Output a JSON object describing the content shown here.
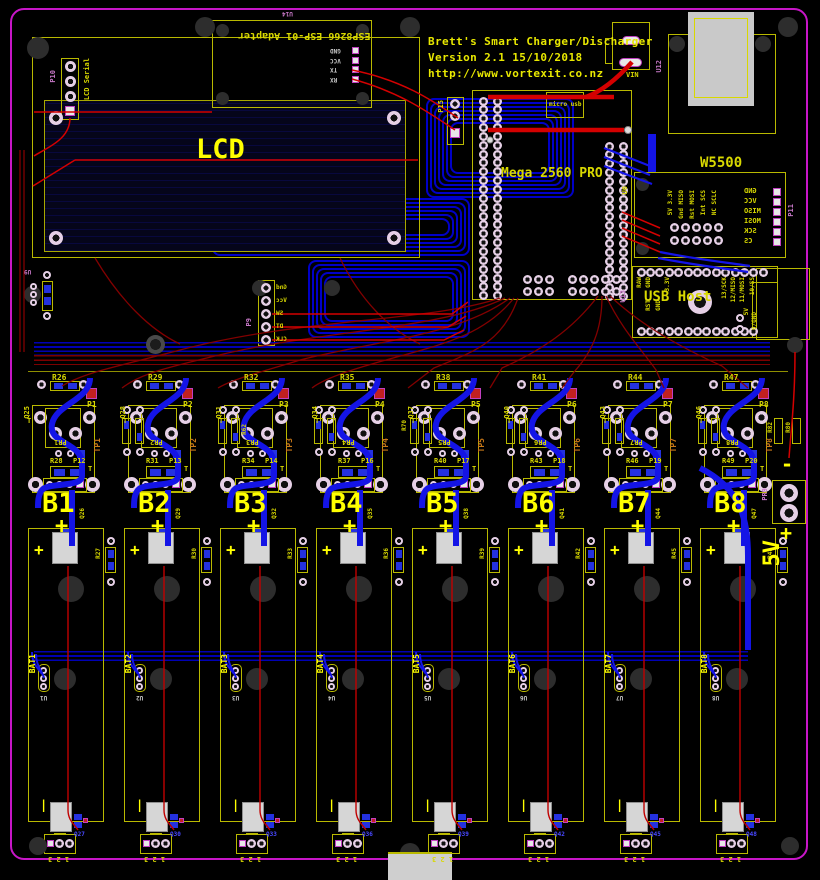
{
  "board_title": {
    "line1": "Brett's Smart Charger/Discharger",
    "line2": "Version 2.1 15/10/2018",
    "line3": "http://www.vortexit.co.nz"
  },
  "colors": {
    "board_edge": "#c816c8",
    "silkscreen": "#b9b900",
    "label_yellow": "#ffff00",
    "trace_red": "#d40000",
    "trace_blue": "#1414e6"
  },
  "esp_adapter": {
    "ref": "U14",
    "name": "ESP8266 ESP-01 Adapter",
    "pins": [
      "GND",
      "VCC",
      "TX",
      "RX"
    ]
  },
  "lcd": {
    "label": "LCD",
    "header_ref": "P10",
    "header_label": "LCD Serial"
  },
  "mega": {
    "name": "Mega 2560 PRO",
    "ref": "U0",
    "micro_usb_label": "micro usb",
    "aux_header_ref": "P15"
  },
  "vin_label": "VIN",
  "usb_b_ref": "U12",
  "w5500": {
    "name": "W5500",
    "header_ref": "P11",
    "column_labels": [
      "5V 3.3V",
      "Gnd MISO",
      "Rst MOSI",
      "Int SCS",
      "NC SCLC"
    ],
    "side_pins": [
      "GND",
      "VCC",
      "MISO",
      "MOSI",
      "SCK",
      "CS"
    ]
  },
  "usb_host": {
    "name": "USB Host",
    "ref": "U13",
    "top_pin_labels": [
      "RAW",
      "GND",
      "",
      "3.3V",
      "",
      "",
      "",
      "",
      "",
      "13/SCK",
      "12/MISO",
      "11/MOSI",
      "10/SS",
      ""
    ],
    "bottom_pin_labels": [
      "",
      "RST",
      "GND",
      "",
      "",
      "",
      "",
      "",
      "",
      "",
      "",
      "",
      ""
    ],
    "aux_pin_labels": [
      "5V",
      "9/GND"
    ]
  },
  "encoder_header": {
    "ref": "P9",
    "pins": [
      "Gnd",
      "Vcc",
      "SW",
      "DT",
      "CLK"
    ]
  },
  "u9_ref": "U9",
  "power_out": {
    "ref": "PR9",
    "neg_label": "-",
    "pos_label": "+",
    "rail_label": "5V"
  },
  "satellite_refs": [
    "R62",
    "R70",
    "R82",
    "R80"
  ],
  "channels": [
    {
      "battery": "B1",
      "plus": "+",
      "r_top": "R26",
      "r_mid": "R28",
      "pad_ref": "P1",
      "conn_ref": "P12",
      "pr_ref": "PR1",
      "tp_ref": "TP1",
      "q_left": "Q25",
      "q_right": "Q26"
    },
    {
      "battery": "B2",
      "plus": "+",
      "r_top": "R29",
      "r_mid": "R31",
      "pad_ref": "P2",
      "conn_ref": "P13",
      "pr_ref": "PR2",
      "tp_ref": "TP2",
      "q_left": "Q28",
      "q_right": "Q29"
    },
    {
      "battery": "B3",
      "plus": "+",
      "r_top": "R32",
      "r_mid": "R34",
      "pad_ref": "P3",
      "conn_ref": "P14",
      "pr_ref": "PR3",
      "tp_ref": "TP3",
      "q_left": "Q31",
      "q_right": "Q32"
    },
    {
      "battery": "B4",
      "plus": "+",
      "r_top": "R35",
      "r_mid": "R37",
      "pad_ref": "P4",
      "conn_ref": "P16",
      "pr_ref": "PR4",
      "tp_ref": "TP4",
      "q_left": "Q34",
      "q_right": "Q35"
    },
    {
      "battery": "B5",
      "plus": "+",
      "r_top": "R38",
      "r_mid": "R40",
      "pad_ref": "P5",
      "conn_ref": "P17",
      "pr_ref": "PR5",
      "tp_ref": "TP5",
      "q_left": "Q37",
      "q_right": "Q38"
    },
    {
      "battery": "B6",
      "plus": "+",
      "r_top": "R41",
      "r_mid": "R43",
      "pad_ref": "P6",
      "conn_ref": "P18",
      "pr_ref": "PR6",
      "tp_ref": "TP6",
      "q_left": "Q40",
      "q_right": "Q41"
    },
    {
      "battery": "B7",
      "plus": "+",
      "r_top": "R44",
      "r_mid": "R46",
      "pad_ref": "P7",
      "conn_ref": "P19",
      "pr_ref": "PR7",
      "tp_ref": "TP7",
      "q_left": "Q43",
      "q_right": "Q44"
    },
    {
      "battery": "B8",
      "plus": "+",
      "r_top": "R47",
      "r_mid": "R49",
      "pad_ref": "P8",
      "conn_ref": "P20",
      "pr_ref": "PR8",
      "tp_ref": "TP8",
      "q_left": "Q46",
      "q_right": "Q47"
    }
  ],
  "batteries": [
    {
      "label": "BAT1",
      "sensor_ref": "U1",
      "divider_ref": "R27",
      "q_ref": "Q27",
      "conn_pins": "1 2 3",
      "plus": "+",
      "minus": "|"
    },
    {
      "label": "BAT2",
      "sensor_ref": "U2",
      "divider_ref": "R30",
      "q_ref": "Q30",
      "conn_pins": "1 2 3",
      "plus": "+",
      "minus": "|"
    },
    {
      "label": "BAT3",
      "sensor_ref": "U3",
      "divider_ref": "R33",
      "q_ref": "Q33",
      "conn_pins": "1 2 3",
      "plus": "+",
      "minus": "|"
    },
    {
      "label": "BAT4",
      "sensor_ref": "U4",
      "divider_ref": "R36",
      "q_ref": "Q36",
      "conn_pins": "1 2 3",
      "plus": "+",
      "minus": "|"
    },
    {
      "label": "BAT5",
      "sensor_ref": "U5",
      "divider_ref": "R39",
      "q_ref": "Q39",
      "conn_pins": "1 2 3",
      "plus": "+",
      "minus": "|"
    },
    {
      "label": "BAT6",
      "sensor_ref": "U6",
      "divider_ref": "R42",
      "q_ref": "Q42",
      "conn_pins": "1 2 3",
      "plus": "+",
      "minus": "|"
    },
    {
      "label": "BAT7",
      "sensor_ref": "U7",
      "divider_ref": "R45",
      "q_ref": "Q45",
      "conn_pins": "1 2 3",
      "plus": "+",
      "minus": "|"
    },
    {
      "label": "BAT8",
      "sensor_ref": "U8",
      "divider_ref": "R48",
      "q_ref": "Q48",
      "conn_pins": "1 2 3",
      "plus": "+",
      "minus": "|"
    }
  ]
}
